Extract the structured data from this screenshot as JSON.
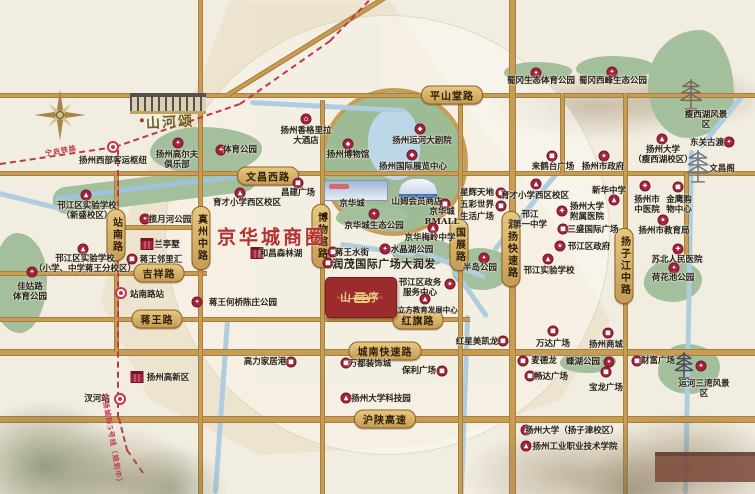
{
  "badge": {
    "name": "山河序",
    "subtext": "SHAN HE XU"
  },
  "labels": {
    "business_district": "京华城商圈",
    "sister_project": "山河颂"
  },
  "colors": {
    "accent_red": "#a3243c",
    "rail_red": "#c0394b",
    "road_gold": "#c79c55",
    "park_green": "#a3bf9b",
    "badge_red": "#9c2b2b",
    "badge_gold": "#e9c981",
    "district_red": "#b23131"
  },
  "icon_glyphs": {
    "school": "▲",
    "hospital": "✚",
    "government": "★",
    "mall": "■",
    "park": "✦",
    "hotel": "⌂",
    "theater": "◆",
    "museum": "◆",
    "expo": "◆"
  },
  "road_banners_h": [
    {
      "label": "平山堂路",
      "x": 452,
      "y": 95
    },
    {
      "label": "文昌西路",
      "x": 268,
      "y": 176
    },
    {
      "label": "吉祥路",
      "x": 159,
      "y": 273
    },
    {
      "label": "蒋王路",
      "x": 157,
      "y": 319
    },
    {
      "label": "红旗路",
      "x": 418,
      "y": 320
    },
    {
      "label": "城南快速路",
      "x": 385,
      "y": 351
    },
    {
      "label": "沪陕高速",
      "x": 385,
      "y": 419
    }
  ],
  "road_banners_v": [
    {
      "label": "站南路",
      "x": 116,
      "y": 235
    },
    {
      "label": "真州中路",
      "x": 201,
      "y": 238
    },
    {
      "label": "博物馆路",
      "x": 321,
      "y": 236
    },
    {
      "label": "国展路",
      "x": 459,
      "y": 245
    },
    {
      "label": "润扬快速路",
      "x": 511,
      "y": 249
    },
    {
      "label": "扬子江中路",
      "x": 624,
      "y": 266
    }
  ],
  "rail_labels": [
    {
      "label": "宁启铁路",
      "x": 61,
      "y": 151,
      "rot": -10
    },
    {
      "label": "宁扬城际5号线（规划中）",
      "x": 112,
      "y": 440,
      "rot": 80
    }
  ],
  "pois": [
    {
      "l": "扬州西部客运枢纽",
      "x": 113,
      "y": 161,
      "t": "metro",
      "ix": 113,
      "iy": 147
    },
    {
      "l": "扬州高尔夫\n俱乐部",
      "x": 177,
      "y": 160,
      "t": "park",
      "ix": 178,
      "iy": 143
    },
    {
      "l": "体育公园",
      "x": 240,
      "y": 150,
      "t": "park",
      "ix": 221,
      "iy": 150
    },
    {
      "l": "邗江区实验学校\n（新盛校区）",
      "x": 87,
      "y": 211,
      "t": "school",
      "ix": 86,
      "iy": 195
    },
    {
      "l": "邗江区实验学校\n（小学、中学蒋王分校区）",
      "x": 85,
      "y": 264,
      "t": "school",
      "ix": 83,
      "iy": 249
    },
    {
      "l": "佳姑路\n体育公园",
      "x": 30,
      "y": 292,
      "t": "park",
      "ix": 32,
      "iy": 272
    },
    {
      "l": "揽月河公园",
      "x": 170,
      "y": 220,
      "t": "park",
      "ix": 145,
      "iy": 219
    },
    {
      "l": "兰亭墅",
      "x": 167,
      "y": 245,
      "t": "building",
      "ix": 147,
      "iy": 244
    },
    {
      "l": "蒋王邻里汇",
      "x": 161,
      "y": 260,
      "t": "mall",
      "ix": 132,
      "iy": 259
    },
    {
      "l": "站南路站",
      "x": 147,
      "y": 295,
      "t": "metro",
      "ix": 121,
      "iy": 293
    },
    {
      "l": "汊河站",
      "x": 97,
      "y": 399,
      "t": "metro",
      "ix": 120,
      "iy": 399
    },
    {
      "l": "扬州高新区",
      "x": 168,
      "y": 378,
      "t": "building",
      "ix": 137,
      "iy": 377
    },
    {
      "l": "蒋王何桥陈庄公园",
      "x": 243,
      "y": 303,
      "t": "park",
      "ix": 197,
      "iy": 302
    },
    {
      "l": "扬州香格里拉\n大酒店",
      "x": 306,
      "y": 136,
      "t": "hotel",
      "ix": 306,
      "iy": 119
    },
    {
      "l": "扬州博物馆",
      "x": 348,
      "y": 155,
      "t": "museum",
      "ix": 348,
      "iy": 144
    },
    {
      "l": "扬州运河大剧院",
      "x": 422,
      "y": 141,
      "t": "theater",
      "ix": 420,
      "iy": 129
    },
    {
      "l": "扬州国际展览中心",
      "x": 413,
      "y": 167,
      "t": "expo",
      "ix": 412,
      "iy": 155
    },
    {
      "l": "昌建广场",
      "x": 298,
      "y": 193,
      "t": "mall",
      "ix": 298,
      "iy": 183
    },
    {
      "l": "京华城",
      "x": 352,
      "y": 204
    },
    {
      "l": "山姆会员商店",
      "x": 417,
      "y": 202
    },
    {
      "l": "京华城\nRMALL",
      "x": 442,
      "y": 217,
      "t": "mall",
      "ix": 445,
      "iy": 204
    },
    {
      "l": "星辉天地",
      "x": 477,
      "y": 193,
      "t": "mall",
      "ix": 501,
      "iy": 193
    },
    {
      "l": "五彩世界",
      "x": 477,
      "y": 205,
      "t": "mall",
      "ix": 501,
      "iy": 206
    },
    {
      "l": "生活广场",
      "x": 477,
      "y": 217
    },
    {
      "l": "京华城生态公园",
      "x": 374,
      "y": 226,
      "t": "park",
      "ix": 374,
      "iy": 214
    },
    {
      "l": "京华梅岭中学",
      "x": 430,
      "y": 238,
      "t": "school",
      "ix": 433,
      "iy": 228
    },
    {
      "l": "水晶湖公园",
      "x": 412,
      "y": 250,
      "t": "park",
      "ix": 385,
      "iy": 249
    },
    {
      "l": "蒋王水街",
      "x": 352,
      "y": 253,
      "t": "mall",
      "ix": 333,
      "iy": 252
    },
    {
      "l": "润茂国际广场大润发",
      "x": 384,
      "y": 264,
      "t": "mall",
      "ix": 328,
      "iy": 263,
      "cls": "big"
    },
    {
      "l": "和昌森林湖",
      "x": 281,
      "y": 254,
      "t": "building",
      "ix": 257,
      "iy": 253
    },
    {
      "l": "半岛公园",
      "x": 480,
      "y": 268,
      "t": "park",
      "ix": 484,
      "iy": 258
    },
    {
      "l": "邗江区政务\n服务中心",
      "x": 420,
      "y": 288,
      "t": "government",
      "ix": 450,
      "iy": 284
    },
    {
      "l": "翼立方教育发展中心",
      "x": 424,
      "y": 310,
      "t": "school",
      "ix": 425,
      "iy": 299,
      "cls": "small"
    },
    {
      "l": "红星美凯龙",
      "x": 477,
      "y": 342,
      "t": "mall",
      "ix": 503,
      "iy": 341
    },
    {
      "l": "蜀冈生态体育公园",
      "x": 541,
      "y": 81,
      "t": "park",
      "ix": 536,
      "iy": 73
    },
    {
      "l": "蜀冈西峰生态公园",
      "x": 613,
      "y": 81,
      "t": "park",
      "ix": 612,
      "iy": 72
    },
    {
      "l": "瘦西湖风景区",
      "x": 706,
      "y": 120
    },
    {
      "l": "东关古渡",
      "x": 707,
      "y": 143,
      "t": "park",
      "ix": 729,
      "iy": 142
    },
    {
      "l": "扬州大学\n（瘦西湖校区）",
      "x": 663,
      "y": 155,
      "t": "school",
      "ix": 662,
      "iy": 139
    },
    {
      "l": "文昌阁",
      "x": 722,
      "y": 169
    },
    {
      "l": "来鹤台广场",
      "x": 553,
      "y": 167,
      "t": "mall",
      "ix": 552,
      "iy": 156
    },
    {
      "l": "扬州市政府",
      "x": 603,
      "y": 167,
      "t": "government",
      "ix": 604,
      "iy": 156
    },
    {
      "l": "育才小学西区校区",
      "x": 247,
      "y": 203,
      "t": "school",
      "ix": 240,
      "iy": 193
    },
    {
      "l": "育才小学西区校区",
      "x": 535,
      "y": 196,
      "t": "school",
      "ix": 536,
      "iy": 184
    },
    {
      "l": "邗江\n第一中学",
      "x": 530,
      "y": 220
    },
    {
      "l": "新华中学",
      "x": 609,
      "y": 191,
      "t": "school",
      "ix": 614,
      "iy": 200
    },
    {
      "l": "扬州大学\n附属医院",
      "x": 587,
      "y": 212,
      "t": "hospital",
      "ix": 562,
      "iy": 211
    },
    {
      "l": "三盛国际广场",
      "x": 593,
      "y": 230,
      "t": "mall",
      "ix": 563,
      "iy": 229
    },
    {
      "l": "邗江区政府",
      "x": 589,
      "y": 247,
      "t": "government",
      "ix": 560,
      "iy": 246
    },
    {
      "l": "邗江实验学校",
      "x": 549,
      "y": 271,
      "t": "school",
      "ix": 548,
      "iy": 259
    },
    {
      "l": "扬州市\n中医院",
      "x": 647,
      "y": 205,
      "t": "hospital",
      "ix": 645,
      "iy": 186
    },
    {
      "l": "金鹰购\n物中心",
      "x": 679,
      "y": 205,
      "t": "mall",
      "ix": 678,
      "iy": 187
    },
    {
      "l": "扬州市教育局",
      "x": 664,
      "y": 231,
      "t": "government",
      "ix": 663,
      "iy": 220
    },
    {
      "l": "苏北人民医院",
      "x": 677,
      "y": 260,
      "t": "hospital",
      "ix": 678,
      "iy": 249
    },
    {
      "l": "荷花池公园",
      "x": 673,
      "y": 278,
      "t": "park",
      "ix": 674,
      "iy": 268
    },
    {
      "l": "高力家居港",
      "x": 265,
      "y": 362,
      "t": "mall",
      "ix": 291,
      "iy": 362
    },
    {
      "l": "万都装饰城",
      "x": 370,
      "y": 364,
      "t": "mall",
      "ix": 346,
      "iy": 363
    },
    {
      "l": "保利广场",
      "x": 419,
      "y": 371,
      "t": "mall",
      "ix": 442,
      "iy": 371
    },
    {
      "l": "扬州大学科技园",
      "x": 381,
      "y": 399,
      "t": "school",
      "ix": 346,
      "iy": 398
    },
    {
      "l": "万达广场",
      "x": 553,
      "y": 344,
      "t": "mall",
      "ix": 553,
      "iy": 331
    },
    {
      "l": "扬州商城",
      "x": 606,
      "y": 345,
      "t": "mall",
      "ix": 608,
      "iy": 333
    },
    {
      "l": "麦德龙",
      "x": 544,
      "y": 361,
      "t": "mall",
      "ix": 523,
      "iy": 361
    },
    {
      "l": "蝶湖公园",
      "x": 583,
      "y": 362,
      "t": "park",
      "ix": 609,
      "iy": 362
    },
    {
      "l": "畅达广场",
      "x": 551,
      "y": 377,
      "t": "mall",
      "ix": 530,
      "iy": 376
    },
    {
      "l": "宝龙广场",
      "x": 606,
      "y": 388,
      "t": "mall",
      "ix": 606,
      "iy": 372
    },
    {
      "l": "财富广场",
      "x": 658,
      "y": 361,
      "t": "mall",
      "ix": 637,
      "iy": 361
    },
    {
      "l": "运河三湾风景区",
      "x": 704,
      "y": 389,
      "t": "park",
      "ix": 701,
      "iy": 366
    },
    {
      "l": "扬州大学（扬子津校区）",
      "x": 572,
      "y": 431,
      "t": "school",
      "ix": 526,
      "iy": 430
    },
    {
      "l": "扬州工业职业技术学院",
      "x": 575,
      "y": 447,
      "t": "school",
      "ix": 526,
      "iy": 446
    }
  ]
}
